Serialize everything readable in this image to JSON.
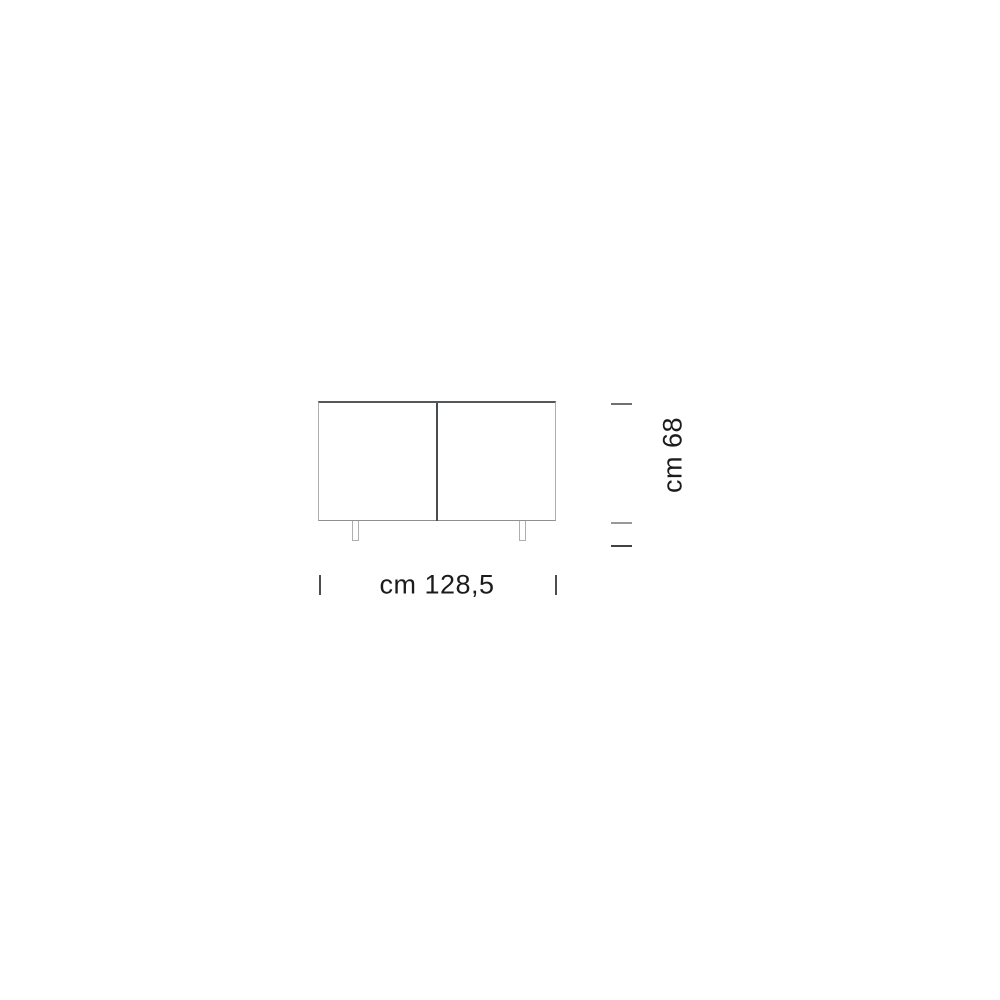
{
  "dimensions": {
    "height_label": "cm 68",
    "width_label": "cm 128,5"
  },
  "colors": {
    "background": "#FFFFFF",
    "outline": "#8E9193",
    "outline_dark": "#55585A",
    "outline_light": "#ADB0B2",
    "divider": "#4A4D4F",
    "tick_top": "#6E7173",
    "tick_middle": "#97999B",
    "tick_bottom": "#3F4244",
    "tick_width": "#4B4E50",
    "text": "#1C1C1E"
  }
}
